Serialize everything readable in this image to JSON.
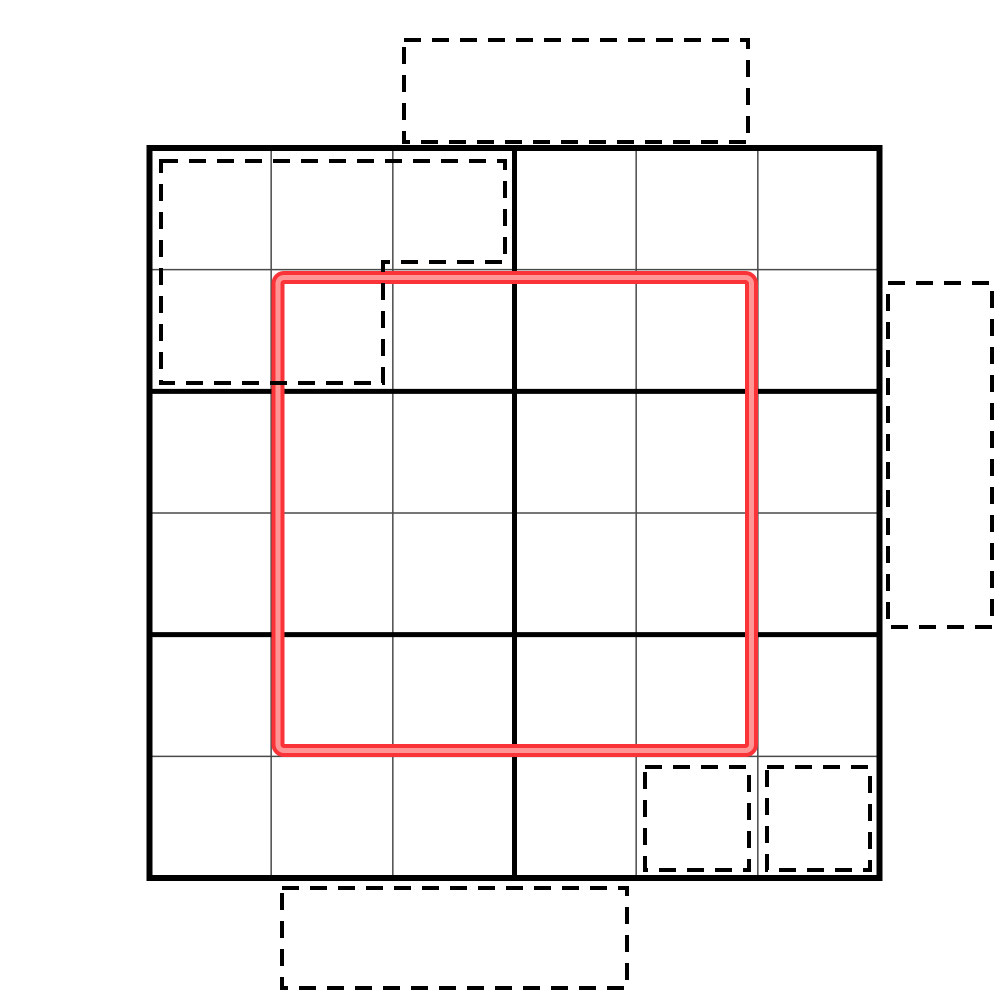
{
  "canvas": {
    "width": 1000,
    "height": 1000,
    "background": "#ffffff"
  },
  "board": {
    "x": 149.5,
    "y": 148,
    "size": 730,
    "cols": 6,
    "rows": 6,
    "block_cols": 3,
    "block_rows": 2,
    "outer_border_width": 6,
    "block_line_width": 5,
    "cell_line_width": 1.5,
    "outer_border_color": "#000000",
    "block_line_color": "#000000",
    "cell_line_color": "#4a4a4a",
    "fill": "#ffffff"
  },
  "red_region": {
    "x": 271.5,
    "y": 271,
    "width": 486.5,
    "height": 486,
    "stroke_width": 13,
    "highlight_width": 5,
    "corner_radius": 6,
    "color": "#fa3338",
    "highlight_color": "#ff9595",
    "grid_span": {
      "col_start": 1,
      "row_start": 1,
      "cols": 4,
      "rows": 4
    }
  },
  "dash_style": {
    "color": "#000000",
    "width": 4,
    "dasharray": "17 11"
  },
  "dashed_shapes": [
    {
      "id": "tray-top",
      "type": "rect",
      "x": 404,
      "y": 40,
      "width": 344,
      "height": 102,
      "location": "outside-top"
    },
    {
      "id": "pentomino-outline",
      "type": "polygon",
      "points": [
        [
          161,
          161
        ],
        [
          505,
          161
        ],
        [
          505,
          262
        ],
        [
          383,
          262
        ],
        [
          383,
          383
        ],
        [
          161,
          383
        ]
      ],
      "location": "board-top-left"
    },
    {
      "id": "tray-right",
      "type": "rect",
      "x": 888,
      "y": 283,
      "width": 104,
      "height": 344,
      "location": "outside-right"
    },
    {
      "id": "tray-bottom",
      "type": "rect",
      "x": 282,
      "y": 888,
      "width": 345,
      "height": 100,
      "location": "outside-bottom"
    },
    {
      "id": "cell-marker-r5c4",
      "type": "rect",
      "x": 645,
      "y": 767,
      "width": 104,
      "height": 103,
      "location": "board-row5-col4"
    },
    {
      "id": "cell-marker-r5c5",
      "type": "rect",
      "x": 767,
      "y": 767,
      "width": 103,
      "height": 103,
      "location": "board-row5-col5"
    }
  ]
}
